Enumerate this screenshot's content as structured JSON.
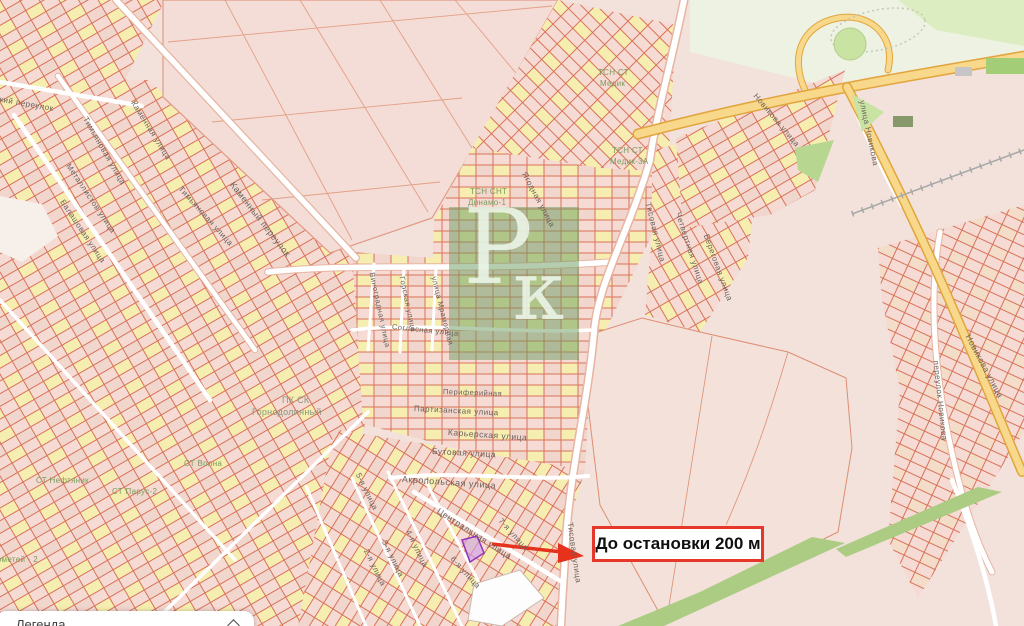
{
  "map": {
    "watermark": {
      "letter1": "Р",
      "letter2": "к"
    },
    "annotation": {
      "label": "До остановки 200 м",
      "arrow_icon": "arrow-right-icon"
    },
    "legend": {
      "title": "Легенда",
      "collapse_icon": "chevron-up-icon"
    },
    "colors": {
      "background": "#f2e2db",
      "parcel_line": "#d97257",
      "parcel_fill_pink": "#f5dbd4",
      "parcel_fill_yellow": "#f6eeb0",
      "road_white": "#ffffff",
      "highway_yellow": "#f8d88b",
      "highway_casing": "#e2a53e",
      "green_area": "#abcc82",
      "green_light": "#cfe5ae",
      "watermark_green": "#699b5f",
      "arrow_red": "#e6311d",
      "annotation_border_red": "#e6382a",
      "highlight_parcel_purple": "#9232bd",
      "street_label_grey": "#6b625c",
      "area_label_green": "#7c9c5c"
    },
    "street_labels": [
      {
        "text": "Технический переулок",
        "x": -38,
        "y": 88,
        "rot": 10,
        "size": 8,
        "kind": "street"
      },
      {
        "text": "Каменная улица",
        "x": 133,
        "y": 97,
        "rot": 58,
        "size": 8,
        "kind": "street"
      },
      {
        "text": "Тимьяновая улица",
        "x": 85,
        "y": 113,
        "rot": 60,
        "size": 8,
        "kind": "street"
      },
      {
        "text": "Каменный переулок",
        "x": 232,
        "y": 178,
        "rot": 52,
        "size": 9,
        "kind": "street"
      },
      {
        "text": "Металлистов улица",
        "x": 68,
        "y": 160,
        "rot": 56,
        "size": 8,
        "kind": "street"
      },
      {
        "text": "Балашовая улица",
        "x": 62,
        "y": 196,
        "rot": 56,
        "size": 8,
        "kind": "street"
      },
      {
        "text": "Тимьяновая улица",
        "x": 180,
        "y": 183,
        "rot": 48,
        "size": 8,
        "kind": "street"
      },
      {
        "text": "Ягодная улица",
        "x": 524,
        "y": 168,
        "rot": 62,
        "size": 8,
        "kind": "street"
      },
      {
        "text": "Тисовая улица",
        "x": 648,
        "y": 198,
        "rot": 76,
        "size": 8,
        "kind": "street"
      },
      {
        "text": "Четвертная улица",
        "x": 678,
        "y": 208,
        "rot": 72,
        "size": 8,
        "kind": "street"
      },
      {
        "text": "Береговая улица",
        "x": 706,
        "y": 230,
        "rot": 70,
        "size": 8,
        "kind": "street"
      },
      {
        "text": "Новикова улица",
        "x": 755,
        "y": 90,
        "rot": 50,
        "size": 8,
        "kind": "street"
      },
      {
        "text": "улица Новикова",
        "x": 862,
        "y": 96,
        "rot": 78,
        "size": 8,
        "kind": "street"
      },
      {
        "text": "Новикова улица",
        "x": 968,
        "y": 330,
        "rot": 62,
        "size": 8.5,
        "kind": "street"
      },
      {
        "text": "переулок Новикова",
        "x": 936,
        "y": 356,
        "rot": 84,
        "size": 8,
        "kind": "street"
      },
      {
        "text": "Виноградная улица",
        "x": 372,
        "y": 268,
        "rot": 78,
        "size": 7.5,
        "kind": "street"
      },
      {
        "text": "Горская улица",
        "x": 402,
        "y": 272,
        "rot": 78,
        "size": 7.5,
        "kind": "street"
      },
      {
        "text": "улица Мраморная",
        "x": 434,
        "y": 272,
        "rot": 76,
        "size": 7.5,
        "kind": "street"
      },
      {
        "text": "Согласная улица",
        "x": 392,
        "y": 322,
        "rot": 6,
        "size": 7.5,
        "kind": "street"
      },
      {
        "text": "Периферийная",
        "x": 443,
        "y": 387,
        "rot": 2,
        "size": 7.5,
        "kind": "street"
      },
      {
        "text": "Партизанская улица",
        "x": 414,
        "y": 404,
        "rot": 3,
        "size": 8,
        "kind": "street"
      },
      {
        "text": "Карьерская улица",
        "x": 448,
        "y": 427,
        "rot": 4,
        "size": 8.5,
        "kind": "street"
      },
      {
        "text": "Бутовая улица",
        "x": 432,
        "y": 446,
        "rot": 3,
        "size": 8.5,
        "kind": "street"
      },
      {
        "text": "Акропольская улица",
        "x": 402,
        "y": 474,
        "rot": 4,
        "size": 9,
        "kind": "street"
      },
      {
        "text": "Центральная улица",
        "x": 438,
        "y": 505,
        "rot": 33,
        "size": 8.5,
        "kind": "street"
      },
      {
        "text": "Тисовая улица",
        "x": 570,
        "y": 518,
        "rot": 82,
        "size": 8,
        "kind": "street"
      },
      {
        "text": "5-я улица",
        "x": 358,
        "y": 469,
        "rot": 64,
        "size": 8,
        "kind": "street"
      },
      {
        "text": "2-я улица",
        "x": 366,
        "y": 545,
        "rot": 64,
        "size": 8,
        "kind": "street"
      },
      {
        "text": "3-я улица",
        "x": 384,
        "y": 536,
        "rot": 64,
        "size": 8,
        "kind": "street"
      },
      {
        "text": "4-я улица",
        "x": 408,
        "y": 526,
        "rot": 64,
        "size": 8,
        "kind": "street"
      },
      {
        "text": "6-я улица",
        "x": 452,
        "y": 553,
        "rot": 48,
        "size": 8,
        "kind": "street"
      },
      {
        "text": "7-я улица",
        "x": 500,
        "y": 515,
        "rot": 48,
        "size": 8,
        "kind": "street"
      },
      {
        "text": "ТСН СТ",
        "x": 598,
        "y": 68,
        "rot": 0,
        "size": 8,
        "kind": "area"
      },
      {
        "text": "Медик",
        "x": 600,
        "y": 79,
        "rot": 0,
        "size": 8,
        "kind": "area"
      },
      {
        "text": "ТСН СТ",
        "x": 612,
        "y": 146,
        "rot": 0,
        "size": 8,
        "kind": "area"
      },
      {
        "text": "Медик-3А",
        "x": 610,
        "y": 157,
        "rot": 0,
        "size": 8,
        "kind": "area"
      },
      {
        "text": "ТСН СНТ",
        "x": 470,
        "y": 187,
        "rot": 0,
        "size": 8,
        "kind": "area"
      },
      {
        "text": "Динамо-1",
        "x": 468,
        "y": 198,
        "rot": 0,
        "size": 8,
        "kind": "area"
      },
      {
        "text": "ПК СК",
        "x": 282,
        "y": 395,
        "rot": 0,
        "size": 9,
        "kind": "area-grey"
      },
      {
        "text": "Горнодолинный",
        "x": 252,
        "y": 407,
        "rot": 0,
        "size": 9,
        "kind": "area-grey"
      },
      {
        "text": "СТ Волна",
        "x": 184,
        "y": 459,
        "rot": 0,
        "size": 8,
        "kind": "area"
      },
      {
        "text": "СТ Парус-2",
        "x": 112,
        "y": 487,
        "rot": 0,
        "size": 8,
        "kind": "area"
      },
      {
        "text": "СТ Нефтяник",
        "x": 36,
        "y": 476,
        "rot": 0,
        "size": 8,
        "kind": "area"
      },
      {
        "text": "Прометей - 2",
        "x": -14,
        "y": 555,
        "rot": 0,
        "size": 8,
        "kind": "area"
      }
    ]
  }
}
